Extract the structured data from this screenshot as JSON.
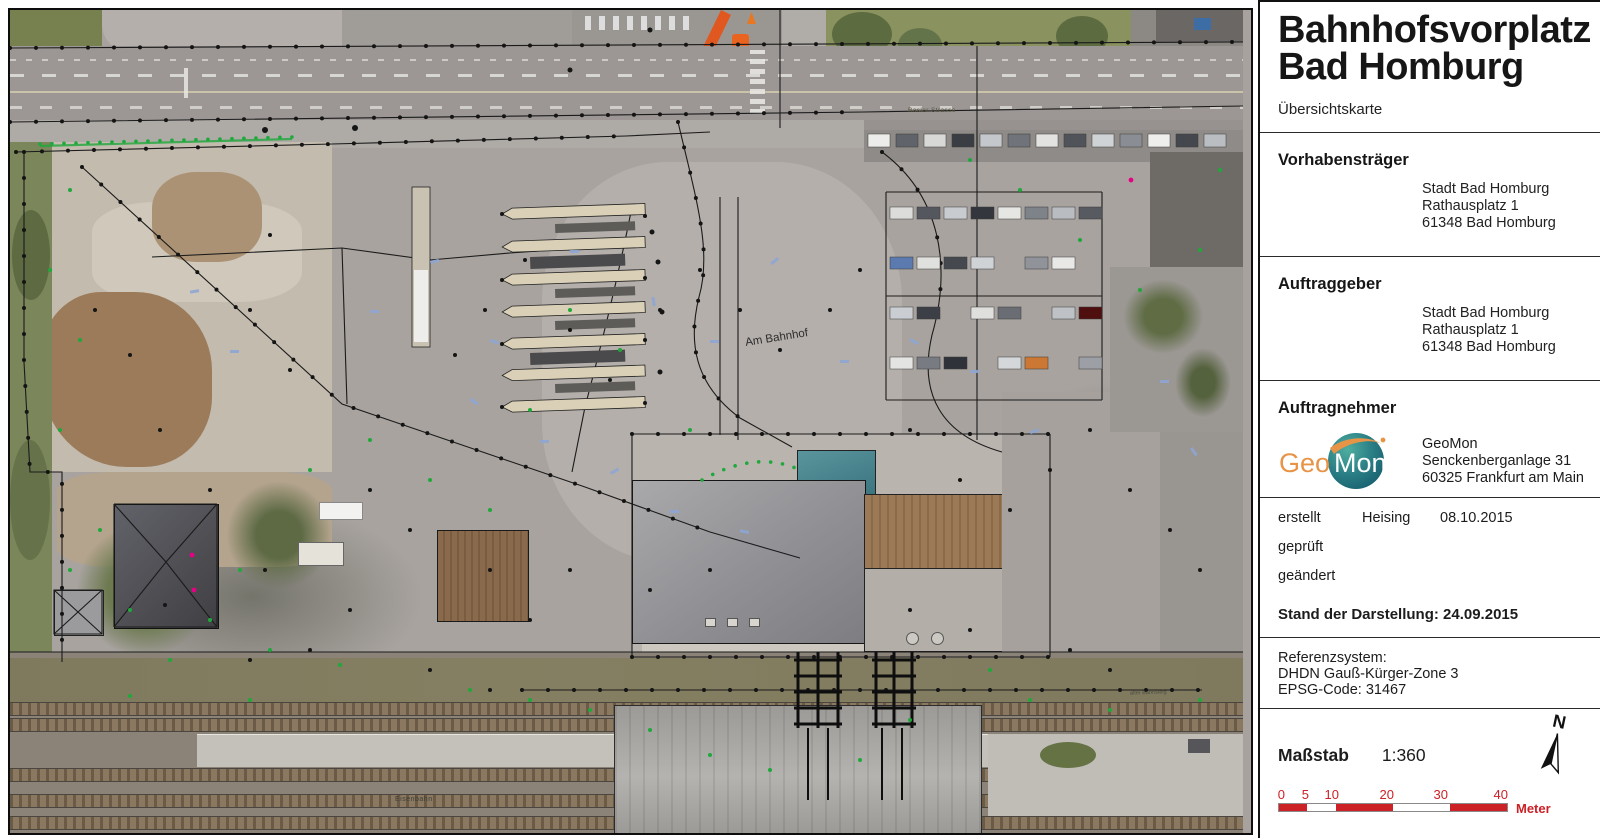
{
  "sidebar": {
    "title_line1": "Bahnhofsvorplatz",
    "title_line2": "Bad Homburg",
    "subtitle": "Übersichtskarte",
    "vorhabenstraeger": {
      "heading": "Vorhabensträger",
      "line1": "Stadt Bad Homburg",
      "line2": "Rathausplatz 1",
      "line3": "61348 Bad Homburg"
    },
    "auftraggeber": {
      "heading": "Auftraggeber",
      "line1": "Stadt Bad Homburg",
      "line2": "Rathausplatz 1",
      "line3": "61348 Bad Homburg"
    },
    "auftragnehmer": {
      "heading": "Auftragnehmer",
      "logo_geo": "Geo",
      "logo_mon": "Mon",
      "line1": "GeoMon",
      "line2": "Senckenberganlage 31",
      "line3": "60325 Frankfurt am Main"
    },
    "revision": {
      "erstellt_label": "erstellt",
      "erstellt_name": "Heising",
      "erstellt_date": "08.10.2015",
      "geprueft_label": "geprüft",
      "geaendert_label": "geändert",
      "stand": "Stand der Darstellung: 24.09.2015"
    },
    "reference": {
      "line1": "Referenzsystem:",
      "line2": "DHDN Gauß-Kürger-Zone 3",
      "line3": "EPSG-Code: 31467"
    },
    "scale": {
      "label": "Maßstab",
      "ratio": "1:360",
      "north": "N",
      "ticks": [
        "0",
        "5",
        "10",
        "20",
        "30",
        "40"
      ],
      "unit": "Meter"
    }
  },
  "map": {
    "labels": {
      "street_top": "Basler Strasse",
      "street_plaza": "Am Bahnhof",
      "railway": "Eisenbahn",
      "platform_note": "alter Bahnsteig"
    }
  },
  "colors": {
    "scale_red": "#cb2127",
    "survey_green": "#1fa83c",
    "survey_magenta": "#e60084",
    "logo_orange": "#e89447",
    "logo_teal": "#206f7b"
  }
}
